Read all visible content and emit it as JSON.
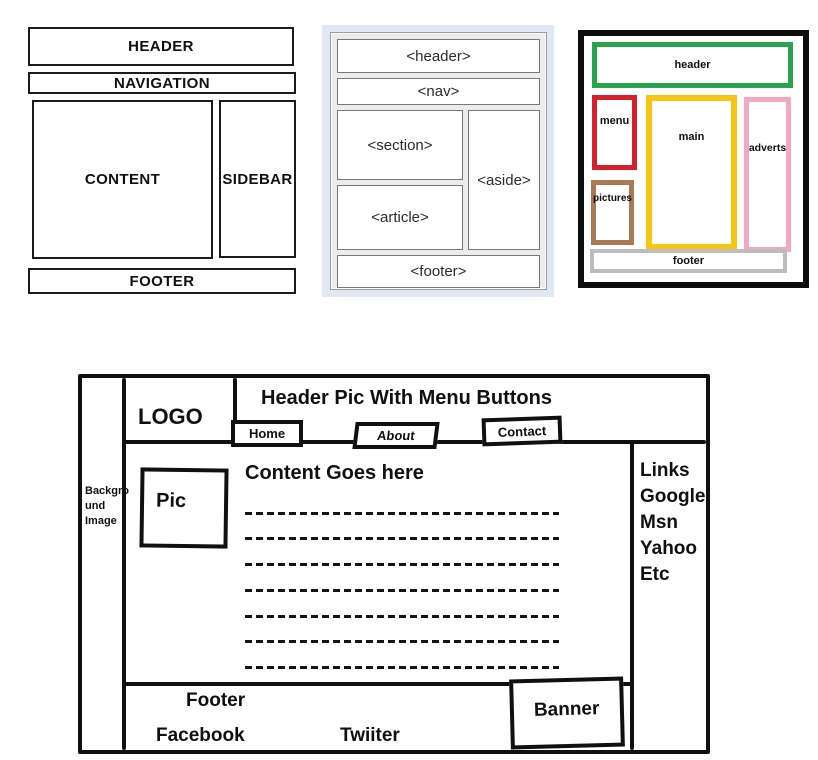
{
  "colors": {
    "semantic_panel_bg": "#dfe8f4",
    "outline_black": "#0d0d0d"
  },
  "diagram_classic": {
    "header": "HEADER",
    "navigation": "NAVIGATION",
    "content": "CONTENT",
    "sidebar": "SIDEBAR",
    "footer": "FOOTER"
  },
  "diagram_semantic": {
    "header": "<header>",
    "nav": "<nav>",
    "section": "<section>",
    "aside": "<aside>",
    "article": "<article>",
    "footer": "<footer>"
  },
  "diagram_colored": {
    "header": {
      "label": "header",
      "color": "#2aa44c"
    },
    "menu": {
      "label": "menu",
      "color": "#d6202a"
    },
    "main": {
      "label": "main",
      "color": "#f9c513"
    },
    "adverts": {
      "label": "adverts",
      "color": "#f3a8c0"
    },
    "pictures": {
      "label": "pictures",
      "color": "#a97a55"
    },
    "footer": {
      "label": "footer",
      "color": "#bcbcbc"
    }
  },
  "wireframe": {
    "background_label": "Backgro und Image",
    "logo": "LOGO",
    "header_title": "Header Pic With Menu Buttons",
    "menu": {
      "home": "Home",
      "about": "About",
      "contact": "Contact"
    },
    "content_heading": "Content Goes here",
    "pic_label": "Pic",
    "links": [
      "Links",
      "Google",
      "Msn",
      "Yahoo",
      "Etc"
    ],
    "footer_label": "Footer",
    "social": {
      "facebook": "Facebook",
      "twitter": "Twiiter"
    },
    "banner_label": "Banner"
  }
}
